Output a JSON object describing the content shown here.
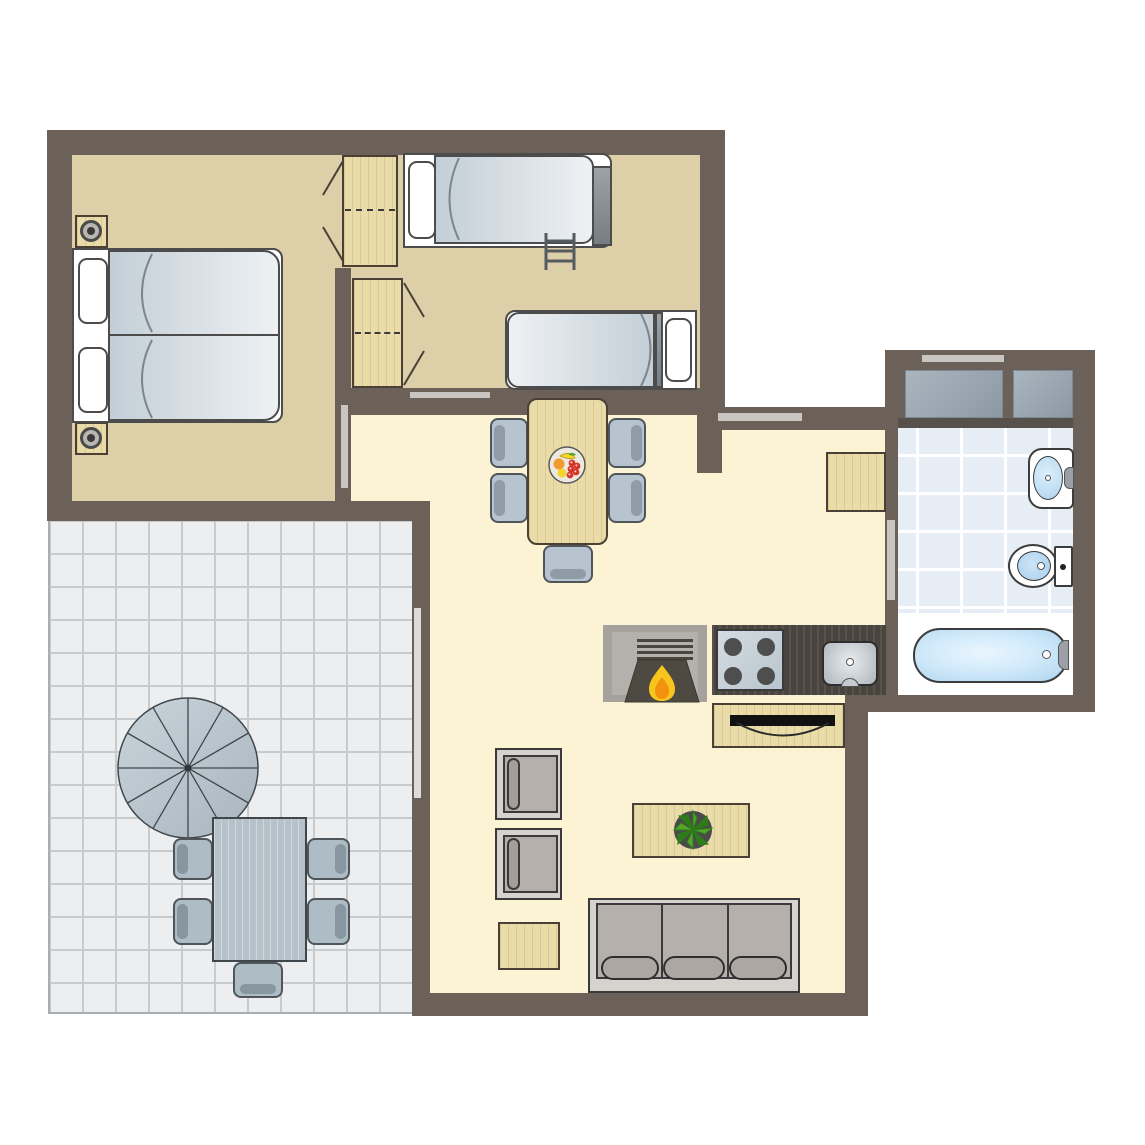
{
  "plan_title": "apartment-floor-plan",
  "colors": {
    "page": "#FFFFFF",
    "wall": "#6B6159",
    "bedroomFloor": "#DDD0A8",
    "livingFloor": "#FCF2D4",
    "terraceTile": "#ECEEF0",
    "terraceGrid": "#C6CBCE",
    "bathTile": "#E7EDF5",
    "bathGrid": "#FFFFFF",
    "woodLight": "#EADCA9",
    "counterWood": "#4A443E",
    "blanketDark": "#C3CED6",
    "blanketLight": "#EEF1F4",
    "chairBlue": "#B7C4CF",
    "chairEdge": "#4E565C",
    "opening": "#C9C6C2",
    "slider": "#DCDCDA",
    "applianceGray": "#9FADB8",
    "waterLight": "#E3F2FC",
    "waterDeep": "#AFD4EE",
    "flameOuter": "#F7C51D",
    "flameInner": "#F2920E",
    "plantGreen": "#55A52C",
    "plantGreenDark": "#2E7C19",
    "fruitOrange": "#F19A2E",
    "fruitYellow": "#F6D42C",
    "fruitRed": "#D63427"
  },
  "rooms": [
    {
      "name": "bedroom-1",
      "furniture": [
        "double-bed",
        "pillow",
        "pillow",
        "nightstand-with-lamp",
        "nightstand-with-lamp",
        "wardrobe"
      ]
    },
    {
      "name": "bedroom-2",
      "furniture": [
        "bunk-bed-with-ladder",
        "single-bed",
        "wardrobe"
      ]
    },
    {
      "name": "dining-area",
      "furniture": [
        "dining-table",
        "fruit-bowl",
        "dining-chair",
        "dining-chair",
        "dining-chair",
        "dining-chair",
        "dining-chair"
      ]
    },
    {
      "name": "kitchen",
      "furniture": [
        "fireplace-stove",
        "cooktop-4-burners",
        "kitchen-sink",
        "counter",
        "tv-cabinet"
      ]
    },
    {
      "name": "living-room",
      "furniture": [
        "armchair",
        "armchair",
        "side-table",
        "coffee-table",
        "potted-plant",
        "sofa-3-seat"
      ]
    },
    {
      "name": "hallway",
      "furniture": [
        "doormat"
      ]
    },
    {
      "name": "bathroom",
      "furniture": [
        "washing-machine",
        "cabinet-block",
        "washbasin",
        "toilet",
        "bathtub"
      ]
    },
    {
      "name": "terrace",
      "furniture": [
        "parasol",
        "outdoor-table",
        "outdoor-chair",
        "outdoor-chair",
        "outdoor-chair",
        "outdoor-chair",
        "outdoor-chair"
      ]
    }
  ],
  "openings": [
    {
      "name": "bedroom-1-door-opening"
    },
    {
      "name": "bedroom-2-door-opening"
    },
    {
      "name": "bedroom-2-interior-window"
    },
    {
      "name": "hall-entrance-window"
    },
    {
      "name": "bathroom-window"
    },
    {
      "name": "bathroom-door-opening"
    },
    {
      "name": "terrace-sliding-door"
    }
  ],
  "counts": {
    "dining_chairs": 5,
    "outdoor_chairs": 5,
    "sofa_seats": 3,
    "cooktop_burners": 4,
    "beds": 4
  }
}
